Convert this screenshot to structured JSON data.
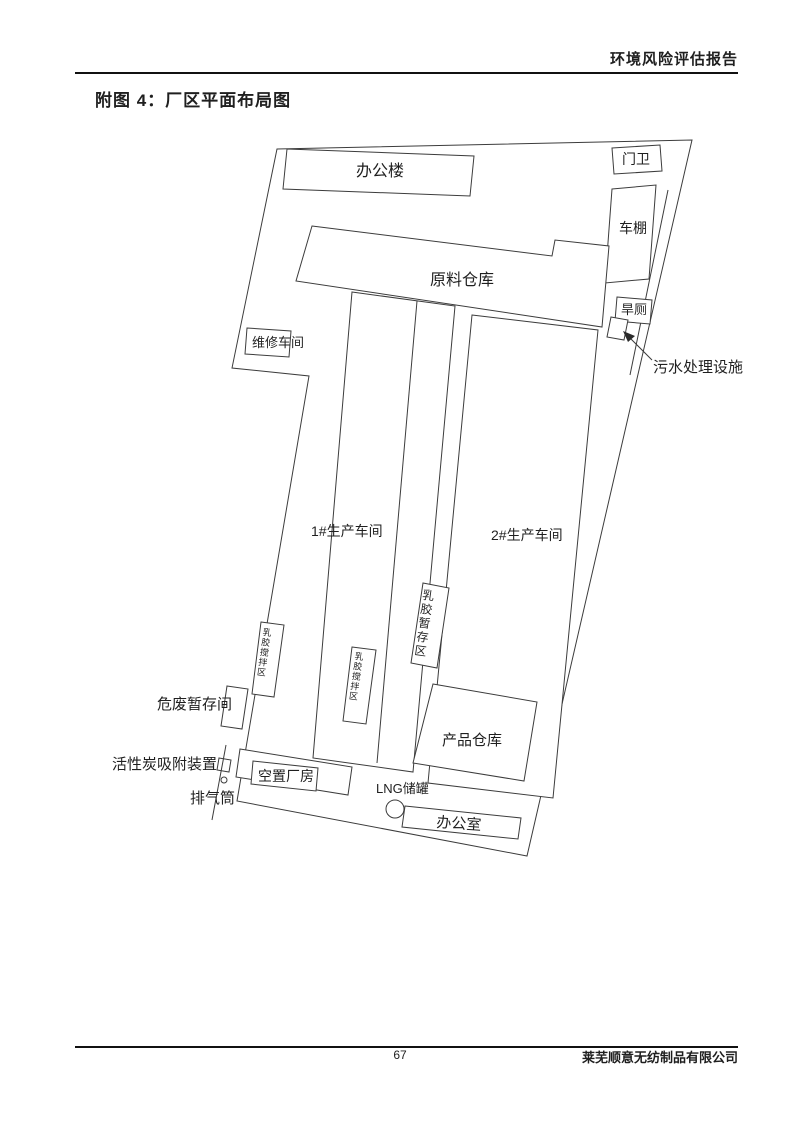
{
  "page": {
    "header": {
      "report_title": "环境风险评估报告"
    },
    "figure": {
      "title": "附图 4：厂区平面布局图"
    },
    "footer": {
      "page_number": "67",
      "company": "莱芜顺意无纺制品有限公司"
    }
  },
  "plant": {
    "labels": {
      "office_building": "办公楼",
      "gate_guard": "门卫",
      "bike_shed": "车棚",
      "raw_material_warehouse": "原料仓库",
      "dry_toilet": "旱厕",
      "sewage_treatment": "污水处理设施",
      "maintenance_workshop": "维修车间",
      "workshop_1": "1#生产车间",
      "workshop_2": "2#生产车间",
      "latex_temp_storage": "乳胶暂存区",
      "latex_mixing_a": "乳胶搅拌区",
      "latex_mixing_b": "乳胶搅拌区",
      "hazardous_waste_room": "危废暂存间",
      "carbon_adsorption": "活性炭吸附装置",
      "exhaust_stack": "排气筒",
      "vacant_factory": "空置厂房",
      "lng_tank": "LNG储罐",
      "office_room": "办公室",
      "product_warehouse": "产品仓库"
    }
  }
}
